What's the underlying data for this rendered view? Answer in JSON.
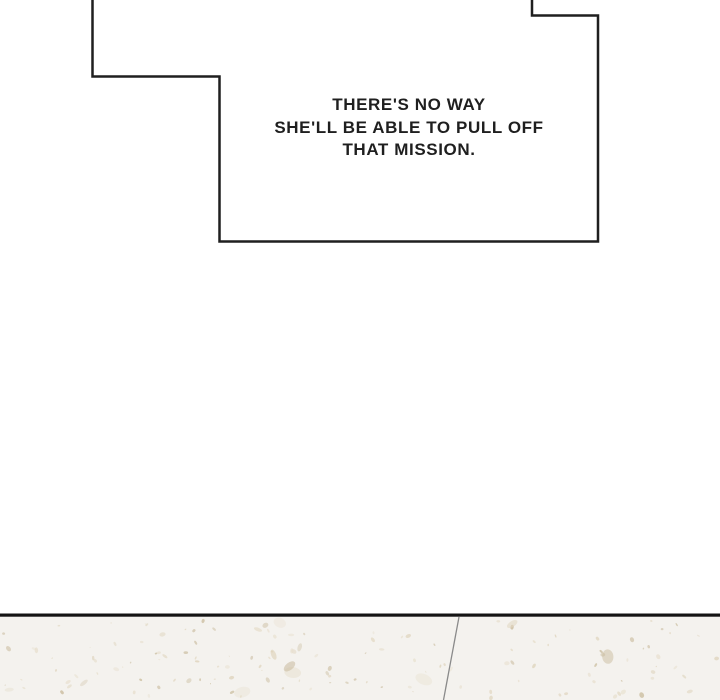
{
  "bubble": {
    "lines": [
      "THERE'S NO WAY",
      "SHE'LL BE ABLE TO PULL OFF",
      "THAT MISSION."
    ]
  },
  "colors": {
    "ink": "#1f1f1f",
    "paper": "#ffffff",
    "floor-base": "#f4f2ee",
    "floor-line": "#141414",
    "floor-seam": "#8a8a8a"
  },
  "floor": {
    "speckle_colors": [
      "#ddd2b9",
      "#e8e0cf",
      "#cabc9e",
      "#e2d8c2"
    ]
  }
}
